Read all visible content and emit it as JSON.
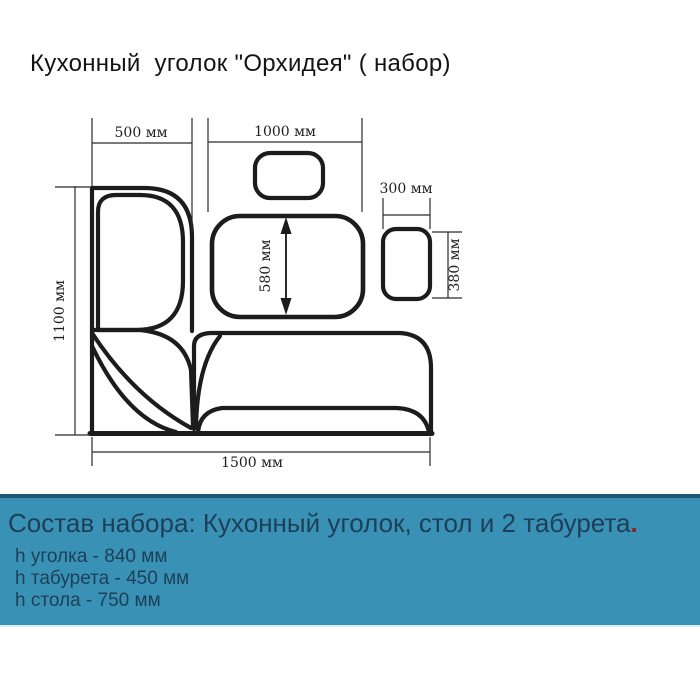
{
  "title": "Кухонный  уголок \"Орхидея\" ( набор)",
  "diagram": {
    "labels": {
      "bench_left_depth": "500 мм",
      "table_width": "1000 мм",
      "stool_width": "300 мм",
      "table_depth": "580 мм",
      "stool_depth": "380 мм",
      "bench_left_length": "1100 мм",
      "bench_bottom_length": "1500 мм"
    }
  },
  "footer": {
    "heading": "Состав набора: Кухонный уголок, стол и 2 табурета",
    "heading_period": ".",
    "specs": [
      "h уголка - 840 мм",
      "h табурета - 450 мм",
      "h стола - 750 мм"
    ]
  },
  "colors": {
    "drawing_line": "#1c1c1c",
    "dimension_line": "#2b2b2b",
    "footer_background": "#3a91b6",
    "footer_text": "#1d3f57",
    "footer_period": "#8a2020"
  }
}
